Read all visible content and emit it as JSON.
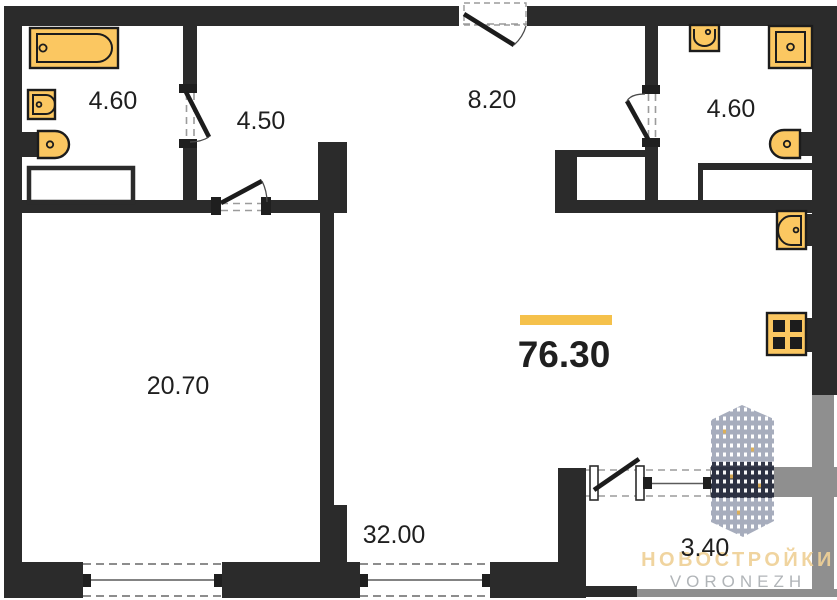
{
  "plan": {
    "title": "apartment-floor-plan",
    "total_area": "76.30",
    "rooms": {
      "bathroom_left": {
        "area": "4.60"
      },
      "wardrobe": {
        "area": "4.50"
      },
      "hallway": {
        "area": "8.20"
      },
      "bathroom_right": {
        "area": "4.60"
      },
      "bedroom": {
        "area": "20.70"
      },
      "kitchen_living": {
        "area": "32.00"
      },
      "balcony": {
        "area": "3.40"
      }
    },
    "fixtures": [
      "bathtub-icon",
      "washbasin-icon",
      "toilet-icon",
      "shower-icon",
      "kitchen-sink-icon",
      "stove-icon"
    ]
  },
  "brand": {
    "name": "НОВОСТРОЙКИ",
    "city": "VORONEZH",
    "logo_icon": "building-tower-icon"
  },
  "colors": {
    "wall": "#2B2B2B",
    "balcony_wall": "#8F8F8F",
    "fixture_fill": "#FBC761",
    "fixture_outline": "#1C1C1C",
    "accent_bar": "#F5C14B",
    "brand_gold": "#EFD197",
    "brand_gray": "#ABAFB3",
    "tower_body": "#A0A7B8",
    "tower_band": "#242A3C",
    "tower_window_accent": "#D9A94B",
    "dashed_line": "#9B9B9B",
    "background": "#FFFFFF"
  }
}
